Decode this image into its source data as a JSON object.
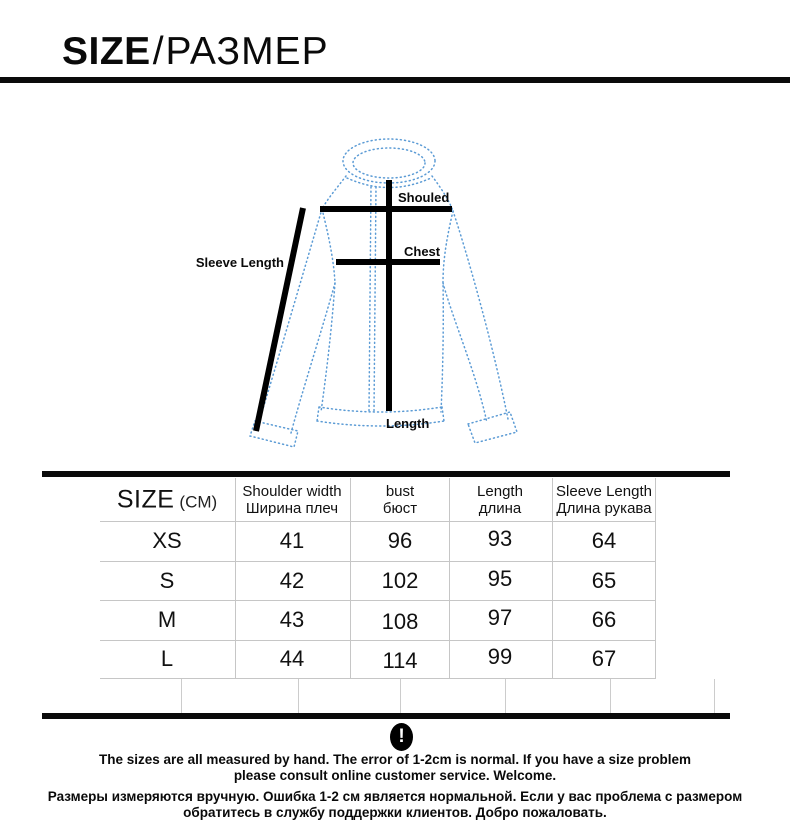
{
  "title": {
    "en": "SIZE",
    "slash": "/",
    "ru": "РАЗМЕР"
  },
  "diagram": {
    "outline_color": "#5b9bd5",
    "measure_color": "#000000",
    "labels": {
      "shoulder": "Shouled",
      "chest": "Chest",
      "sleeve_length": "Sleeve Length",
      "length": "Length"
    }
  },
  "size_table": {
    "corner": {
      "label": "SIZE",
      "unit": "(CM)"
    },
    "columns": [
      {
        "en": "Shoulder width",
        "ru": "Ширина плеч"
      },
      {
        "en": "bust",
        "ru": "бюст"
      },
      {
        "en": "Length",
        "ru": "длина"
      },
      {
        "en": "Sleeve Length",
        "ru": "Длина рукава"
      }
    ],
    "rows": [
      {
        "size": "XS",
        "shoulder": "41",
        "bust": "96",
        "length": "93",
        "sleeve": "64"
      },
      {
        "size": "S",
        "shoulder": "42",
        "bust": "102",
        "length": "95",
        "sleeve": "65"
      },
      {
        "size": "M",
        "shoulder": "43",
        "bust": "108",
        "length": "97",
        "sleeve": "66"
      },
      {
        "size": "L",
        "shoulder": "44",
        "bust": "114",
        "length": "99",
        "sleeve": "67"
      }
    ]
  },
  "notice": {
    "icon_glyph": "!",
    "en_line1": "The sizes are all measured by hand. The error of 1-2cm is normal. If you have a size problem",
    "en_line2": "please consult online customer service. Welcome.",
    "ru_line1": "Размеры измеряются вручную. Ошибка 1-2 см является нормальной. Если у вас проблема с размером",
    "ru_line2": "обратитесь в службу поддержки клиентов. Добро пожаловать."
  }
}
